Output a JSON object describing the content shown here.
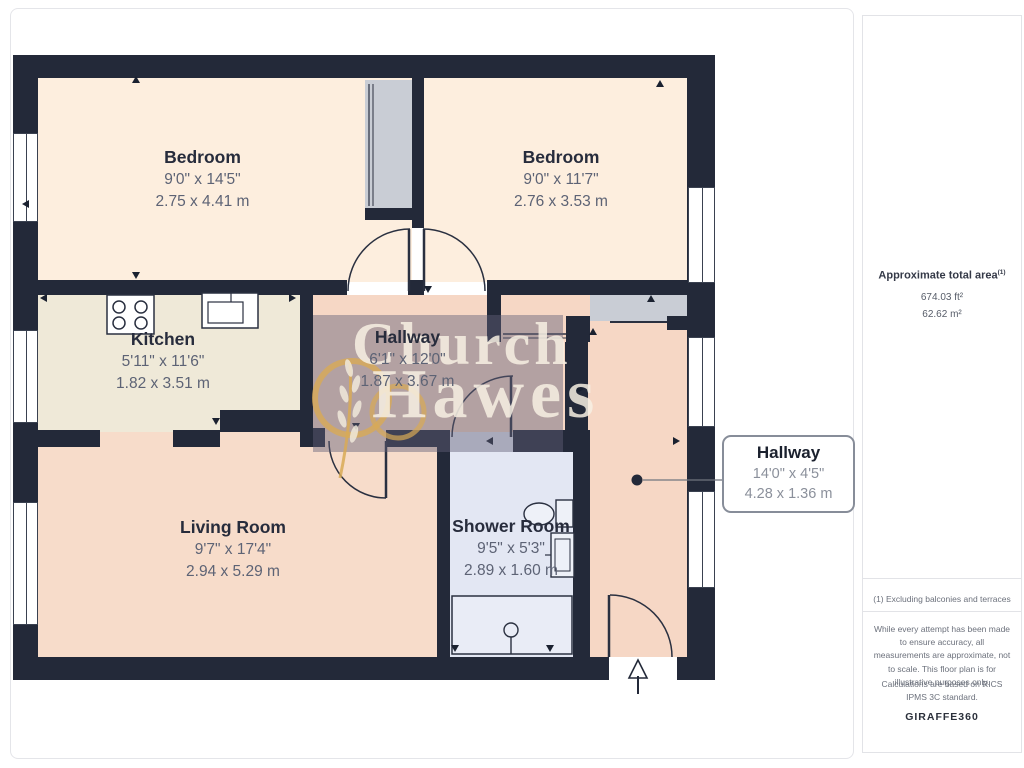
{
  "watermark": {
    "line1": "Church",
    "line2": "Hawes"
  },
  "rooms": [
    {
      "id": "bedroom-1",
      "name": "Bedroom",
      "imperial": "9'0\" x 14'5\"",
      "metric": "2.75 x 4.41 m"
    },
    {
      "id": "bedroom-2",
      "name": "Bedroom",
      "imperial": "9'0\" x 11'7\"",
      "metric": "2.76 x 3.53 m"
    },
    {
      "id": "kitchen",
      "name": "Kitchen",
      "imperial": "5'11\" x 11'6\"",
      "metric": "1.82 x 3.51 m"
    },
    {
      "id": "hallway",
      "name": "Hallway",
      "imperial": "6'1\" x 12'0\"",
      "metric": "1.87 x 3.67 m"
    },
    {
      "id": "living-room",
      "name": "Living Room",
      "imperial": "9'7\" x 17'4\"",
      "metric": "2.94 x 5.29 m"
    },
    {
      "id": "shower-room",
      "name": "Shower Room",
      "imperial": "9'5\" x 5'3\"",
      "metric": "2.89 x 1.60 m"
    }
  ],
  "callout": {
    "name": "Hallway",
    "imperial": "14'0\" x 4'5\"",
    "metric": "4.28 x 1.36 m"
  },
  "sidebar": {
    "area_title": "Approximate total area",
    "area_title_sup": "(1)",
    "area_ft": "674.03 ft²",
    "area_m": "62.62 m²",
    "footnote": "(1) Excluding balconies and terraces",
    "disclaimer": "While every attempt has been made to ensure accuracy, all measurements are approximate, not to scale. This floor plan is for illustrative purposes only.",
    "standard": "Calculations are based on RICS IPMS 3C standard.",
    "brand": "GIRAFFE",
    "brand_suffix": "360"
  },
  "colors": {
    "wall": "#232939",
    "bedroom_fill": "#fdeede",
    "kitchen_fill": "#efe9d8",
    "living_fill": "#f7dcca",
    "hallway_fill": "#f6d7c5",
    "shower_fill": "#e3e7f3",
    "closet_fill": "#c9cdd5",
    "watermark_gold": "#d8aa56",
    "watermark_cream": "#f7f0e3"
  }
}
